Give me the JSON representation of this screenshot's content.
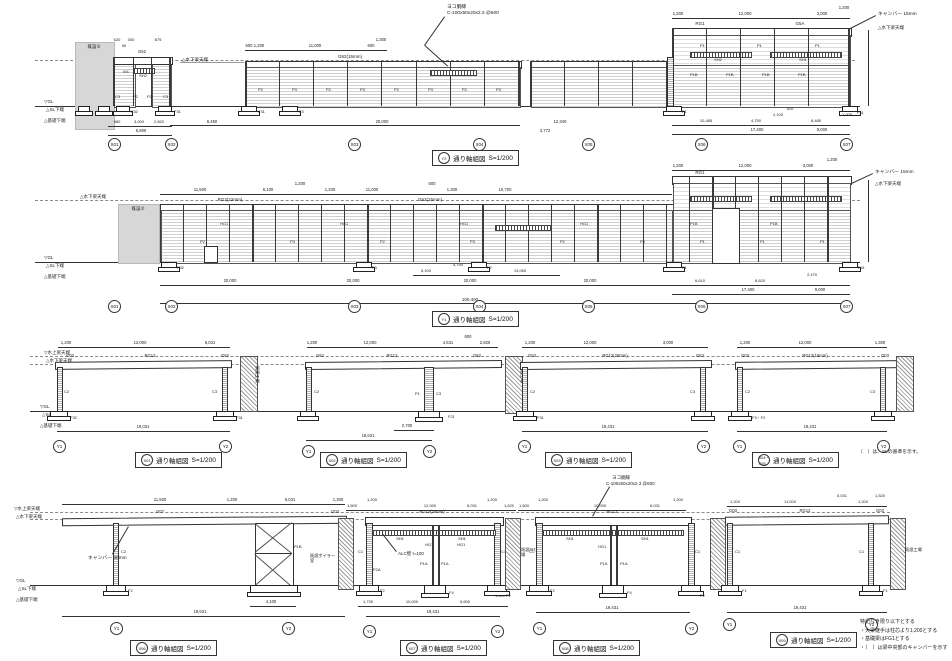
{
  "drawing": {
    "captions": [
      {
        "bubble": "Y2",
        "title": "通り軸組図",
        "scale": "S=1/200"
      },
      {
        "bubble": "Y1",
        "title": "通り軸組図",
        "scale": "S=1/200"
      },
      {
        "bubble": "X01",
        "title": "通り軸組図",
        "scale": "S=1/200"
      },
      {
        "bubble": "X02",
        "title": "通り軸組図",
        "scale": "S=1/200"
      },
      {
        "bubble": "X03",
        "title": "通り軸組図",
        "scale": "S=1/200"
      },
      {
        "bubble": "X04・X05",
        "title": "通り軸組図",
        "scale": "S=1/200"
      },
      {
        "bubble": "X06",
        "title": "通り軸組図",
        "scale": "S=1/200"
      },
      {
        "bubble": "X07",
        "title": "通り軸組図",
        "scale": "S=1/200"
      },
      {
        "bubble": "X08",
        "title": "通り軸組図",
        "scale": "S=1/200"
      },
      {
        "bubble": "X09",
        "title": "通り軸組図",
        "scale": "S=1/200"
      }
    ],
    "grid_x": [
      "X01",
      "X02",
      "X03",
      "X04",
      "X05",
      "X06",
      "X07"
    ],
    "grid_y": [
      "Y1",
      "Y2"
    ],
    "levels": {
      "mizukami": "▽水上梁天端",
      "mizushimo": "△水下梁天端",
      "gl": "▽GL",
      "sl": "△SL下端",
      "kiso": "△基礎下端"
    },
    "callouts": {
      "girt1": "ヨコ胴縁",
      "girt2": "C-100x50x20x2.3 @600",
      "camber15": "キャンバー 15mm",
      "camber30": "キャンバー 30mm",
      "alc": "ALC壁 t=100",
      "existing": "既設②",
      "boiler": "既設ボイラー室",
      "sh_factory": "既設SH工場",
      "factory": "既設工場"
    },
    "note_row3": "（　）は、SLの基準を示す。",
    "notes": [
      "特記なき限り以下とする",
      "・大梁継手は柱芯より1,200とする",
      "・基礎梁はFG1とする",
      "・（　）は梁中央部のキャンバーを示す"
    ],
    "members": {
      "g62": "G62",
      "g62_15": "G62(15mm)",
      "rg2_22": "RG2(22mm)",
      "g03": "G03",
      "g07": "G07",
      "g5a": "G5A",
      "rg1": "RG1",
      "rg12": "RG12",
      "rg12_15": "RG12(15mm)",
      "rg12_20": "RG12(20mm)",
      "rg12_25": "RG12(25mm)",
      "sh1": "SH1",
      "sh2": "SH2",
      "hg1": "HG1",
      "w1": "W1",
      "p1": "P1",
      "p2": "P2",
      "p3": "P3",
      "p1a": "P1A",
      "p1b": "P1B",
      "p2a": "P2A",
      "c1": "C1",
      "c2": "C2",
      "c3": "C3",
      "f1": "F1",
      "f2": "F2",
      "f3": "F3",
      "f4": "F4",
      "f21": "F21",
      "f31": "F31",
      "f32": "F32",
      "f41": "F41",
      "f3f2": "F3・F2"
    },
    "dims": {
      "r1": {
        "smallTop": [
          "620",
          "50",
          "300",
          "875"
        ],
        "smallBot": [
          "980",
          "3,000",
          "2,820"
        ],
        "smallTot": [
          "6,800"
        ],
        "bTop": [
          "500",
          "1,200",
          "11,000",
          "600",
          "1,300"
        ],
        "bBot": [
          "6,450",
          "20,000"
        ],
        "cBot": [
          "12,340",
          "3,772"
        ],
        "cTop": [
          "1,200",
          "12,000",
          "3,000",
          "1,200"
        ],
        "rBot": [
          "10,485",
          "4,750",
          "2,100",
          "510",
          "8,485",
          "1,005"
        ],
        "rTot": [
          "17,400",
          "9,000"
        ],
        "vRight": [
          "11,300"
        ],
        "vLeft": [
          "6,650"
        ],
        "vLeft2": [
          "1,450"
        ]
      },
      "r2": {
        "top": [
          "11,500",
          "6,100",
          "1,200",
          "1,200",
          "11,000",
          "600",
          "1,300",
          "10,700"
        ],
        "topRight": [
          "1,200",
          "12,000",
          "3,000",
          "1,200"
        ],
        "bot": [
          "20,000",
          "20,000",
          "20,000",
          "20,000"
        ],
        "total": [
          "100,400"
        ],
        "subRight": [
          "5,100",
          "4,750",
          "13,050"
        ],
        "right": [
          "6,610",
          "8,620",
          "2,470"
        ],
        "rTot": [
          "17,400",
          "9,000"
        ],
        "vRight": [
          "11,300"
        ],
        "vLeft": [
          "6,100"
        ],
        "vLeft2": [
          "1,450"
        ]
      },
      "r3": {
        "f1Top": [
          "1,200",
          "12,000",
          "6,031"
        ],
        "f1Tot": [
          "19,031"
        ],
        "f2Top": [
          "1,200",
          "12,000",
          "4,631",
          "600",
          "2,820"
        ],
        "f2Sub": [
          "2,700"
        ],
        "f2Tot": [
          "18,631"
        ],
        "f3Top": [
          "1,200",
          "12,000",
          "3,000"
        ],
        "f3Tot": [
          "19,431"
        ],
        "f4Top": [
          "1,200",
          "12,000",
          "1,300"
        ],
        "f4Tot": [
          "19,431"
        ],
        "vLeft": [
          "6,800"
        ]
      },
      "r4": {
        "f1Top": [
          "11,500",
          "1,200",
          "6,031",
          "1,300"
        ],
        "f1Sub": [
          "4,100"
        ],
        "f1Tot": [
          "19,631"
        ],
        "f2Top": [
          "1,500",
          "1,200",
          "12,000",
          "6,031",
          "1,200",
          "1,620"
        ],
        "f2Bot": [
          "1,735",
          "10,000",
          "500",
          "6,600",
          "1,300"
        ],
        "f2Tot": [
          "19,431"
        ],
        "f3Top": [
          "1,500",
          "1,200",
          "10,000",
          "6,031",
          "1,200"
        ],
        "f3Tot": [
          "19,431"
        ],
        "f4Top": [
          "1,200",
          "11,000",
          "5,031",
          "1,200",
          "1,520"
        ],
        "f4Tot": [
          "19,431"
        ],
        "vLeft": [
          "6,800"
        ]
      }
    }
  }
}
